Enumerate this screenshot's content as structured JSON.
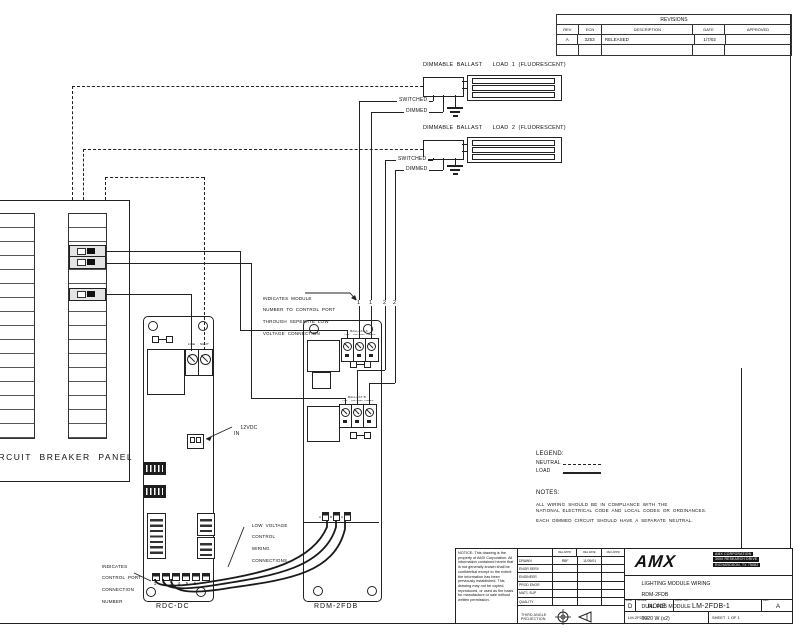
{
  "revisions": {
    "title": "REVISIONS",
    "columns": [
      "REV",
      "ECN",
      "DESCRIPTION",
      "DATE",
      "APPROVED"
    ],
    "rows": [
      {
        "rev": "A",
        "ecn": "3253",
        "description": "RELEASED",
        "date": "1/7/02",
        "approved": ""
      }
    ]
  },
  "loads": [
    {
      "title": "DIMMABLE  BALLAST      LOAD  1  (FLUORESCENT)",
      "switched": "SWITCHED",
      "dimmed": "DIMMED"
    },
    {
      "title": "DIMMABLE  BALLAST      LOAD  2  (FLUORESCENT)",
      "switched": "SWITCHED",
      "dimmed": "DIMMED"
    }
  ],
  "panel": {
    "label": "CIRCUIT  BREAKER  PANEL"
  },
  "rdc": {
    "label": "RDC-DC",
    "line": "LINE",
    "neut": "NEUT",
    "dc1": "12VDC",
    "dc2": "IN",
    "ports": [
      "1",
      "2",
      "3",
      "4",
      "5",
      "6"
    ]
  },
  "rdm": {
    "label": "RDM-2FDB",
    "sections": [
      {
        "name": "BALLAST A",
        "terminals": [
          "LINE",
          "SWITCHED",
          "DIMMED"
        ]
      },
      {
        "name": "BALLAST B",
        "terminals": [
          "LINE",
          "SWITCHED",
          "DIMMED"
        ]
      }
    ],
    "pins": [
      "A",
      "B",
      "C"
    ],
    "module_numbers": [
      "1",
      "1",
      "2",
      "2"
    ]
  },
  "annotations": {
    "module_number": [
      "INDICATES  MODULE",
      "NUMBER  TO  CONTROL  PORT",
      "THROUGH  SEPERATE  LOW",
      "VOLTAGE  CONNECTION"
    ],
    "low_voltage": [
      "LOW  VOLTAGE",
      "CONTROL",
      "WIRING",
      "CONNECTIONS"
    ],
    "control_port": [
      "INDICATES",
      "CONTROL  PORT",
      "CONNECTION",
      "NUMBER"
    ]
  },
  "legend": {
    "title": "LEGEND:",
    "neutral": "NEUTRAL",
    "load": "LOAD"
  },
  "notes": {
    "title": "NOTES:",
    "line1": "ALL  WIRING  SHOULD  BE  IN  COMPLIANCE  WITH  THE",
    "line2": "NATIONAL  ELECTRICAL  CODE  AND  LOCAL  CODES  OR  ORDINANCES.",
    "line3": "EACH  DIMMED  CIRCUIT  SHOULD  HAVE  A  SEPARATE  NEUTRAL."
  },
  "title_block": {
    "notice": "NOTICE:  This drawing is the property of AMX Corporation. All information contained herein that is not generally known shall be confidential except to the extent the information has been previously established. This drawing may not be copied, reproduced, or used as the basis for manufacture or sale without written permission.",
    "sig_headers": [
      "REL APPR",
      "REL DATE",
      "REV APPR"
    ],
    "sig_rows": [
      {
        "role": "DRAWN",
        "v1": "RBF",
        "v2": "11/05/01",
        "v3": ""
      },
      {
        "role": "ENGR SERV",
        "v1": "",
        "v2": "",
        "v3": ""
      },
      {
        "role": "ENGINEER",
        "v1": "",
        "v2": "",
        "v3": ""
      },
      {
        "role": "PROD ENGR",
        "v1": "",
        "v2": "",
        "v3": ""
      },
      {
        "role": "MAT'L SUP",
        "v1": "",
        "v2": "",
        "v3": ""
      },
      {
        "role": "QUALITY",
        "v1": "",
        "v2": "",
        "v3": ""
      }
    ],
    "projection": "THIRD ANGLE\nPROJECTION",
    "logo": "AMX",
    "company": [
      "AMX CORPORATION",
      "3000 RESEARCH DRIVE",
      "RICHARDSON, TX 75082"
    ],
    "titles": [
      "LIGHTING MODULE WIRING",
      "RDM-2FDB",
      "DUAL FDB MODULE",
      "1920 W (x2)"
    ],
    "size_label": "SIZE",
    "size": "D",
    "scale_label": "SCALE",
    "scale": "NONE",
    "dwg_label": "DWG. NO.",
    "dwg_no": "LM-2FDB-1",
    "rev_label": "REV",
    "rev": "A",
    "footer_dwg": "LM-2FDB-1",
    "sheet": "SHEET  1 OF 1"
  }
}
